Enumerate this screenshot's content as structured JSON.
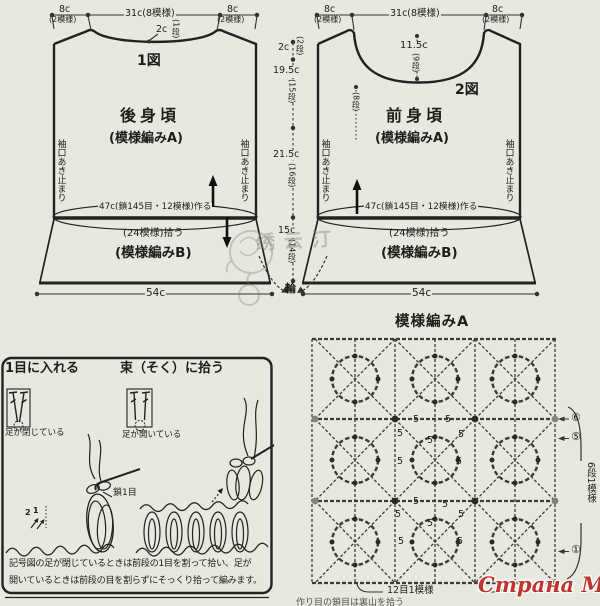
{
  "colors": {
    "paper": "#e6e9e0",
    "ink": "#1d1d1b",
    "red": "#c0332f"
  },
  "back": {
    "fig": "1図",
    "name": "後身頃",
    "pattern_a": "(模様編みA)",
    "shoulder_left": "8c",
    "shoulder_left_sub": "(2模様)",
    "top_width": "31c(8模様)",
    "shoulder_right": "8c",
    "shoulder_right_sub": "(2模様)",
    "neck_drop": "2c",
    "neck_drop_rows": "(1段)",
    "armhole_left": "袖口あき止まり",
    "armhole_right": "袖口あき止まり",
    "cast_on": "47c(鎖145目・12模様)作る",
    "pick_up": "(24模様)拾う",
    "pattern_b": "(模様編みB)",
    "hem_width": "54c"
  },
  "front": {
    "fig": "2図",
    "name": "前身頃",
    "pattern_a": "(模様編みA)",
    "shoulder_left": "8c",
    "shoulder_left_sub": "(2模様)",
    "top_width": "31c(8模様)",
    "shoulder_right": "8c",
    "shoulder_right_sub": "(2模様)",
    "neck_depth": "11.5c",
    "neck_depth_rows": "(9段)",
    "neck_side_rows": "(8段)",
    "armhole_left": "袖口あき止まり",
    "armhole_right": "袖口あき止まり",
    "cast_on": "47c(鎖145目・12模様)作る",
    "pick_up": "(24模様)拾う",
    "pattern_b": "(模様編みB)",
    "hem_width": "54c"
  },
  "center": {
    "yoke": "2c",
    "yoke_rows": "(2段)",
    "upper": "19.5c",
    "upper_rows": "(15段)",
    "lower": "21.5c",
    "lower_rows": "(16段)",
    "hem": "15c",
    "hem_rows": "(14段)",
    "ring": "輪"
  },
  "chart": {
    "title": "模様編みA",
    "h_repeat": "12目1模様",
    "v_repeat": "6段1模様",
    "marker_6": "⑥",
    "marker_5": "⑤",
    "marker_1": "①",
    "chain_count": "5",
    "footnote": "作り目の鎖目は裏山を拾う"
  },
  "howto": {
    "title_split": "1目に入れる",
    "caption_split": "足が閉じている",
    "title_whole": "束（そく）に拾う",
    "caption_whole": "足が開いている",
    "chain_label": "鎖1目",
    "num_2": "2",
    "num_1": "1",
    "note_1": "記号図の足が閉じているときは前段の1目を割って拾い、足が",
    "note_2": "開いているときは前段の目を割らずにそっくり拾って編みます。"
  },
  "watermark": {
    "site": "Страна Мам",
    "stamp": "绣云汀"
  }
}
